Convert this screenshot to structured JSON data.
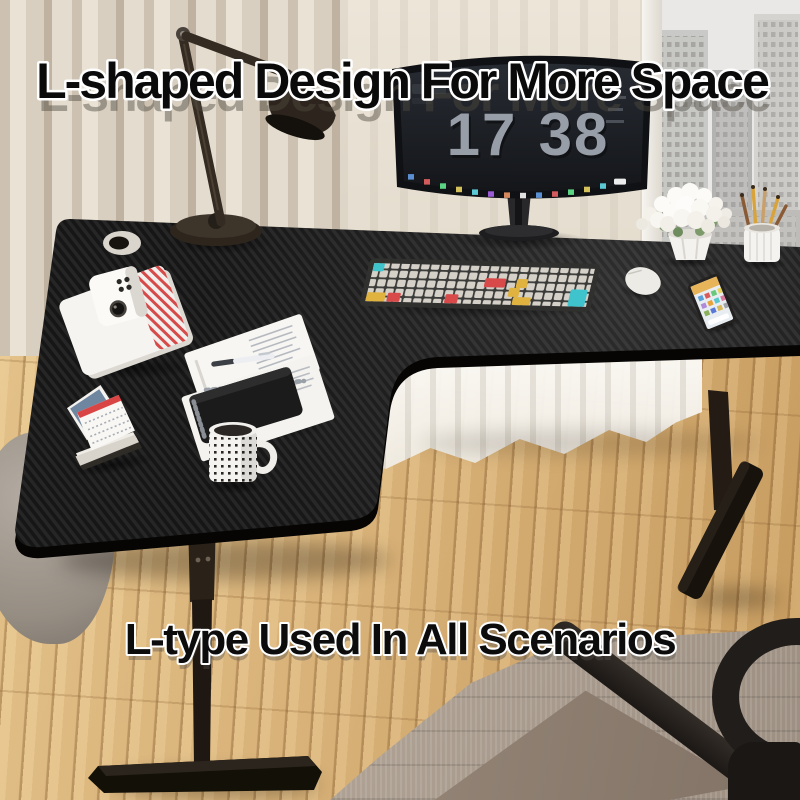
{
  "overlays": {
    "headline": "L-shaped Design For More Space",
    "subline": "L-type Used In All Scenarios"
  },
  "monitor_screen": {
    "clock_hours": "17",
    "clock_minutes": "38"
  },
  "palette": {
    "desk_carbon_dark": "#151515",
    "desk_carbon_light": "#242424",
    "frame_black": "#1c1712",
    "floor_wood": "#dcb67c",
    "rug_taupe": "#a89b8e",
    "curtain_beige": "#d8cfc0",
    "sheer_white": "#f3f1ec",
    "keyboard_accent_red": "#d84a4a",
    "keyboard_accent_yellow": "#e0b23f",
    "keyboard_accent_cyan": "#40c4cd",
    "headline_fill": "#0a0a0a",
    "headline_outline": "#ffffff",
    "clock_color": "#989ea8"
  },
  "scene_objects": [
    "l-shaped-desk",
    "desk-lamp",
    "curved-monitor",
    "mechanical-keyboard",
    "mouse",
    "smartphone",
    "flower-pot",
    "pen-cup",
    "white-book",
    "instant-camera",
    "papers",
    "pen",
    "black-notebook",
    "desk-calendar",
    "coffee-mug",
    "office-chair",
    "rug",
    "window-city-view",
    "sheer-curtain",
    "grommet-hole"
  ]
}
